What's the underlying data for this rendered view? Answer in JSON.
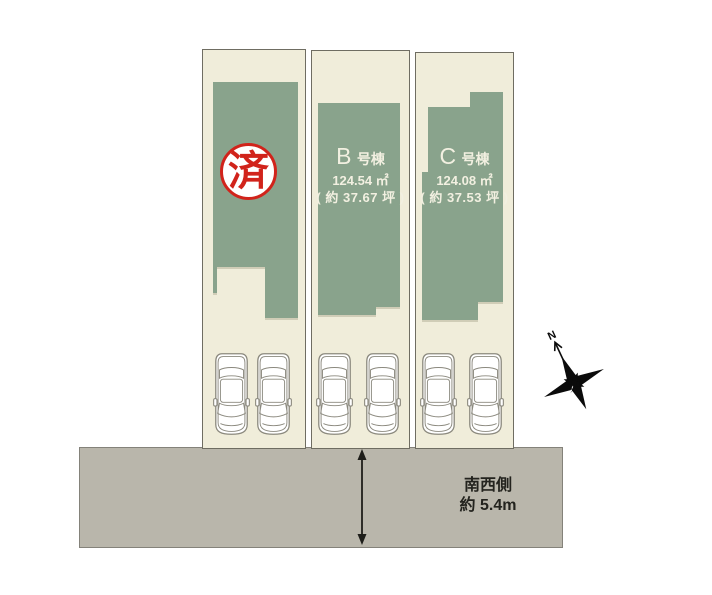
{
  "colors": {
    "lot_bg": "#f0edda",
    "building": "#89a38c",
    "building_text": "#f2f0e1",
    "line": "#6f6d62",
    "road": "#b9b6ab",
    "road_border": "#84827a",
    "road_text": "#23231e",
    "stamp_red": "#d1231b",
    "car_outline": "#8b897e"
  },
  "lot_a": {
    "stamp_text": "済"
  },
  "lot_b": {
    "unit": "B",
    "unit_suffix": "号棟",
    "area": "124.54 ㎡",
    "area_tsubo": "( 約 37.67 坪 )"
  },
  "lot_c": {
    "unit": "C",
    "unit_suffix": "号棟",
    "area": "124.08 ㎡",
    "area_tsubo": "( 約 37.53 坪 )"
  },
  "road": {
    "side_label": "南西側",
    "width_label": "約 5.4m"
  },
  "compass": {
    "north_label": "N"
  }
}
